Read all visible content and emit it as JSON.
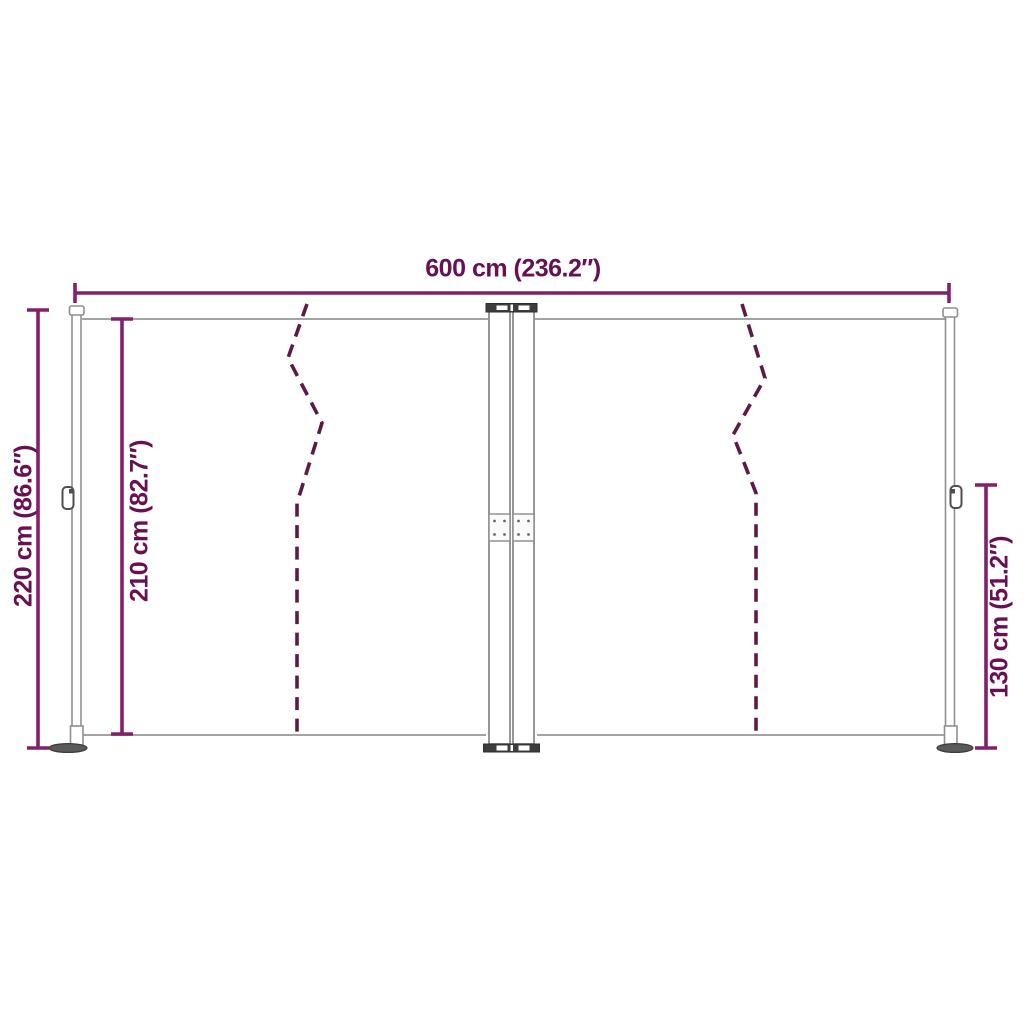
{
  "diagram": {
    "subject": "double retractable side awning dimension drawing",
    "labels": {
      "width_total": "600 cm (236.2″)",
      "height_total": "220 cm (86.6″)",
      "height_fabric": "210 cm (82.7″)",
      "height_right": "130 cm (51.2″)"
    },
    "values": {
      "width_total_cm": 600,
      "width_total_in": 236.2,
      "height_total_cm": 220,
      "height_total_in": 86.6,
      "height_fabric_cm": 210,
      "height_fabric_in": 82.7,
      "height_right_cm": 130,
      "height_right_in": 51.2
    },
    "colors": {
      "dimension_line": "#822069",
      "dimension_text": "#671053",
      "fold_line": "#5d1a45",
      "structure_line": "#8f8f8f",
      "structure_dark": "#3d3d3d",
      "background": "#ffffff"
    }
  }
}
